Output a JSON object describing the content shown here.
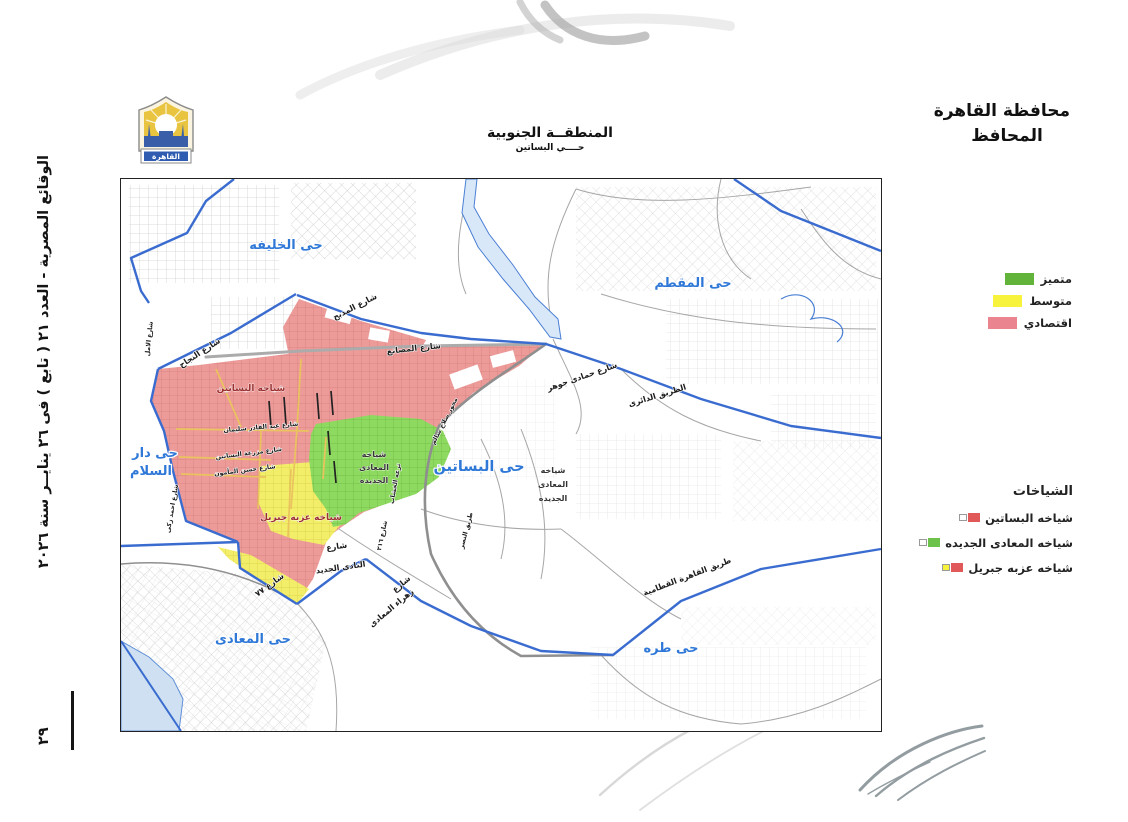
{
  "sidebar": {
    "issue_line": "الوقائع المصرية - العدد ٢١ ( تابع ) فى ٢٦ ينايــر سنة ٢٠٢٦",
    "page_number": "٢٩"
  },
  "governorate": {
    "title": "محافظة القاهرة",
    "subtitle": "المحافظ"
  },
  "map_header": {
    "title": "المنطقــة الجنوبية",
    "subtitle": "حــــي البساتين",
    "logo_text": "القاهرة"
  },
  "legend_quality": {
    "items": [
      {
        "label": "متميز",
        "color": "#61b33a"
      },
      {
        "label": "متوسط",
        "color": "#f7f23c"
      },
      {
        "label": "اقتصادي",
        "color": "#ea8590"
      }
    ]
  },
  "legend_sheyakhat": {
    "title": "الشياخات",
    "items": [
      {
        "label": "شياخه البساتين",
        "c1": "#e05858",
        "c2": "#ffffff"
      },
      {
        "label": "شياخه المعادى الجديده",
        "c1": "#6cc24a",
        "c2": "#ffffff"
      },
      {
        "label": "شياخه عزبه جبريل",
        "c1": "#e05858",
        "c2": "#f7f23c"
      }
    ]
  },
  "map_labels": {
    "districts": {
      "khalifa": "حى الخليفه",
      "moqattam": "حى المقطم",
      "basatin": "حى البساتين",
      "dar_el_salam_1": "حى دار",
      "dar_el_salam_2": "السلام",
      "maadi": "حى المعادى",
      "tora": "حى طره"
    },
    "streets": {
      "najah": "شارع النجاح",
      "madbah": "شارع المدبح",
      "masanea": "شارع المصانع",
      "hammadi_gohar": "شارع حمادى جوهر",
      "ring_road": "الطريق الدائرى",
      "mehwar": "محور صلاح سالم",
      "katameya": "طريق القاهرة القطامية",
      "zahraa_1": "شارع",
      "zahraa_2": "زهراء المعادى",
      "nadi_1": "شارع",
      "nadi_2": "النادى الجديد",
      "st_77": "شارع ٧٧",
      "st_216": "شارع ٢١٦",
      "tariq_nasr": "طريق النصر",
      "abdel_qader": "شارع عبد القادر سليمان",
      "mazraa": "شارع مزرعة البساتين",
      "hassan": "شارع حسن المأمون",
      "amal": "شارع الامل",
      "ahmed_zaki": "شارع احمد زكى",
      "teraa": "ترعه الخشاب"
    },
    "zones": {
      "basatin": "شياخه البساتين",
      "ezbet_gebril": "شياخه عزبه جبريل",
      "maadi_new_1": "شياخه",
      "maadi_new_2": "المعادى",
      "maadi_new_3": "الجديده"
    }
  }
}
